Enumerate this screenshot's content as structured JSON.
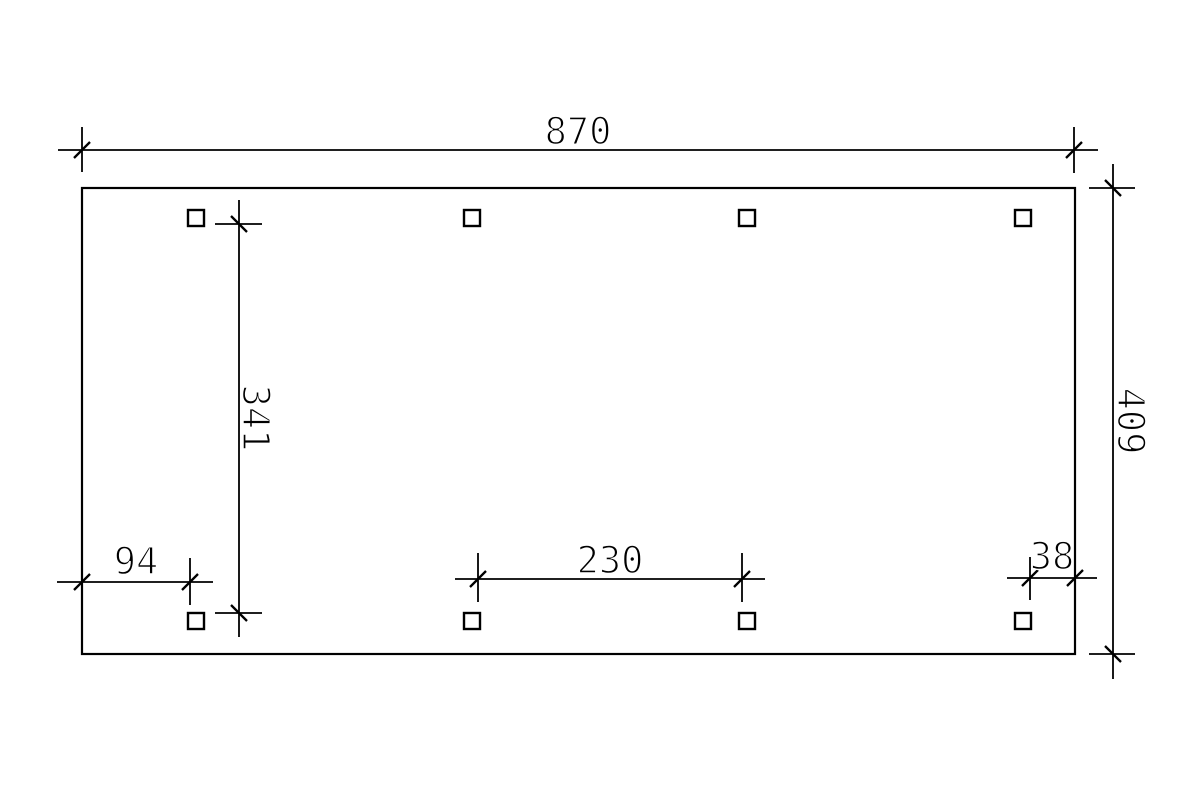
{
  "page": {
    "background": "#ffffff",
    "line_color": "#000000"
  },
  "drawing": {
    "kind": "dimensioned-ground-plan",
    "labels": {
      "width_total": "870",
      "height_total": "409",
      "height_inner": "341",
      "offset_left": "94",
      "span_center": "230",
      "offset_right": "38"
    },
    "posts": {
      "count": 8,
      "shape": "square"
    }
  }
}
